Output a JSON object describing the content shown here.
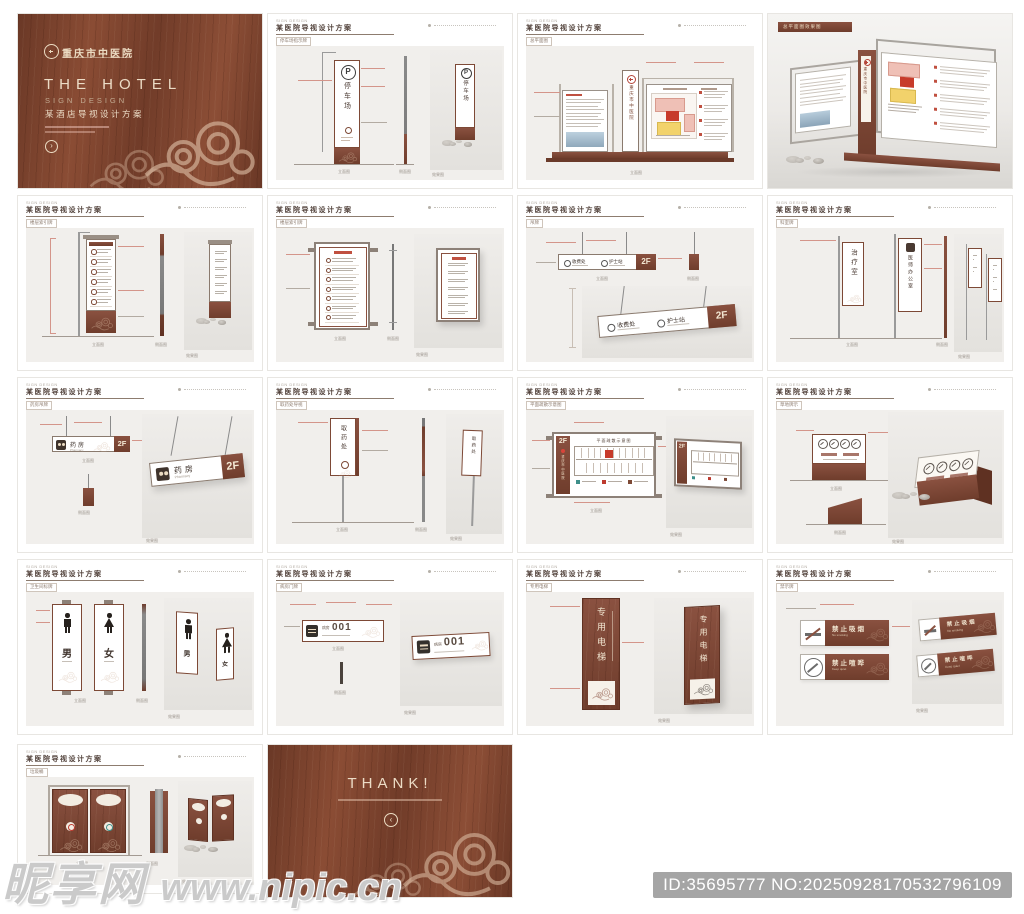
{
  "meta": {
    "watermark_brand": "昵享网",
    "watermark_url": "www.nipic.cn",
    "id_badge": "ID:35695777 NO:20250928170532796109"
  },
  "colors": {
    "wood": "#7c4433",
    "wood_dark": "#5f3122",
    "sign_brown": "#7d4936",
    "cream": "#ecdcc3",
    "panel_gray": "#f1efec",
    "render_gray": "#e9e7e3",
    "accent_red": "#b5463a",
    "map_pink": "#efc0b6",
    "map_red": "#c73b2b",
    "map_yellow": "#f2d26b",
    "badge_gray": "#a5a5a5"
  },
  "cover": {
    "hospital": "重庆市中医院",
    "title_en": "THE HOTEL",
    "subtitle_en": "SIGN DESIGN",
    "title_cn": "某酒店导视设计方案",
    "arrow": "›"
  },
  "thank": {
    "title": "THANK!",
    "arrow": "‹"
  },
  "sheet": {
    "brand": "SIGN DESIGN",
    "title": "某医院导视设计方案",
    "captions": {
      "front": "立面图",
      "side": "侧面图",
      "render": "效果图"
    }
  },
  "pages": {
    "parking": {
      "tag": "停车场指示牌",
      "p": "P",
      "text": "停车场"
    },
    "masterplan": {
      "tag": "总平面图",
      "pylon": "重庆市中医院"
    },
    "renderfull": {
      "tag": "总平面图效果图"
    },
    "directory": {
      "tag": "楼层索引牌"
    },
    "walldir": {
      "tag": "楼层索引牌"
    },
    "hanging": {
      "tag": "吊牌",
      "room1": "收费处",
      "room2": "护士站",
      "floor": "2F"
    },
    "flags": {
      "tag": "科室牌",
      "sign1": "治疗室",
      "sign2": "医师办公室"
    },
    "pharmacy": {
      "tag": "药房吊牌",
      "name": "药房",
      "en": "Pharmacy",
      "floor": "2F"
    },
    "flagtall": {
      "tag": "取药处导视",
      "name": "取药处"
    },
    "floormap": {
      "tag": "平面疏散示意图",
      "title": "平面疏散示意图",
      "floor": "2F",
      "strip": "重庆市中医院"
    },
    "lawn": {
      "tag": "草地牌示"
    },
    "toilet": {
      "tag": "卫生间标牌",
      "male": "男",
      "female": "女"
    },
    "room": {
      "tag": "病房门牌",
      "label": "病房",
      "num": "001"
    },
    "elevator": {
      "tag": "专用电梯",
      "name": "专用电梯"
    },
    "prohibit": {
      "tag": "禁示牌",
      "no_smoking": "禁止吸烟",
      "no_smoking_en": "No smoking",
      "keep_quiet": "禁止喧哗",
      "keep_quiet_en": "Keep quiet"
    },
    "trash": {
      "tag": "垃圾桶"
    }
  }
}
